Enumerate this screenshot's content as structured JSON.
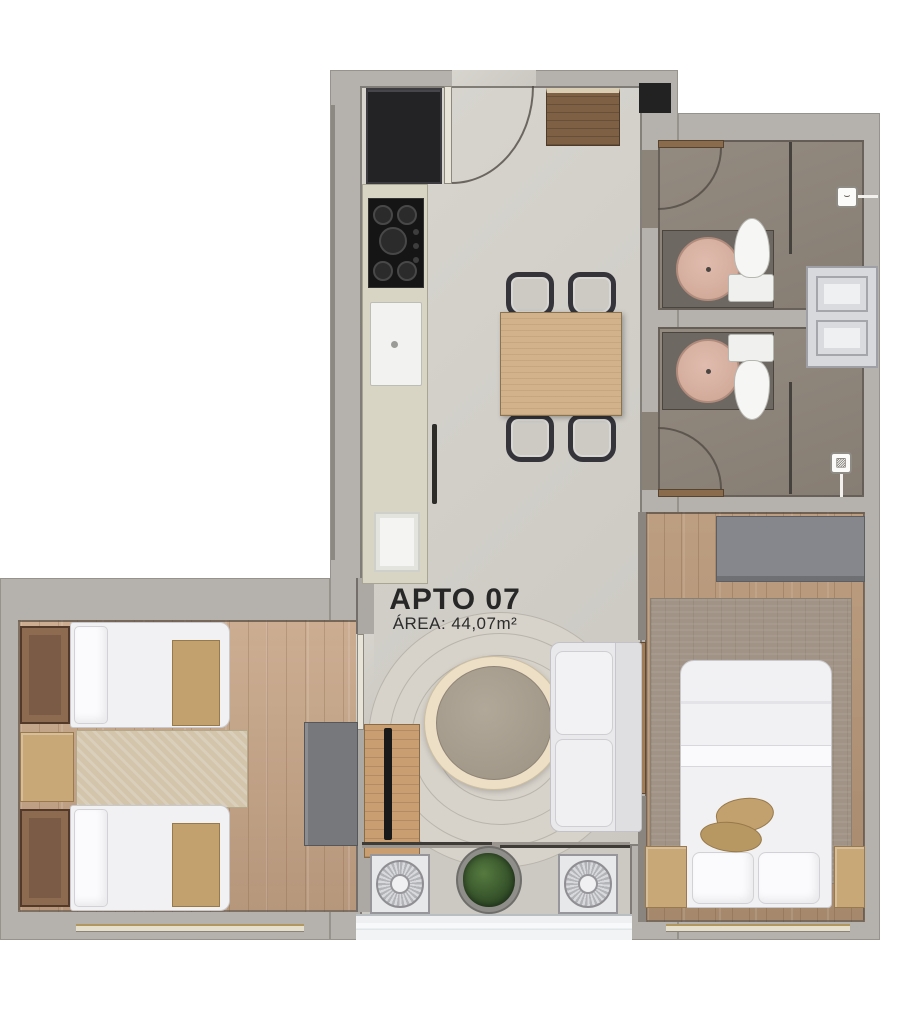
{
  "labels": {
    "unit": "APTO 07",
    "area": "ÁREA: 44,07m²"
  },
  "icons": {
    "shower_drain_top": "⌣",
    "shower_drain_bottom": "▨"
  },
  "colors": {
    "background": "#ffffff",
    "wall": "#b5b2ad",
    "wall_edge": "#57524c",
    "floor_concrete": "#d3d0ca",
    "floor_wood": "#c6a486",
    "floor_bathroom": "#8c8379",
    "rug_round": "#d7d3cb",
    "pouf": "#a79d8e",
    "wood_furniture": "#d2b28a",
    "appliance_dark": "#232326",
    "sanitary_white": "#f2f2f0",
    "basin_pink": "#d6b0a2",
    "plant_green": "#3a5a2c",
    "text": "#272727"
  }
}
